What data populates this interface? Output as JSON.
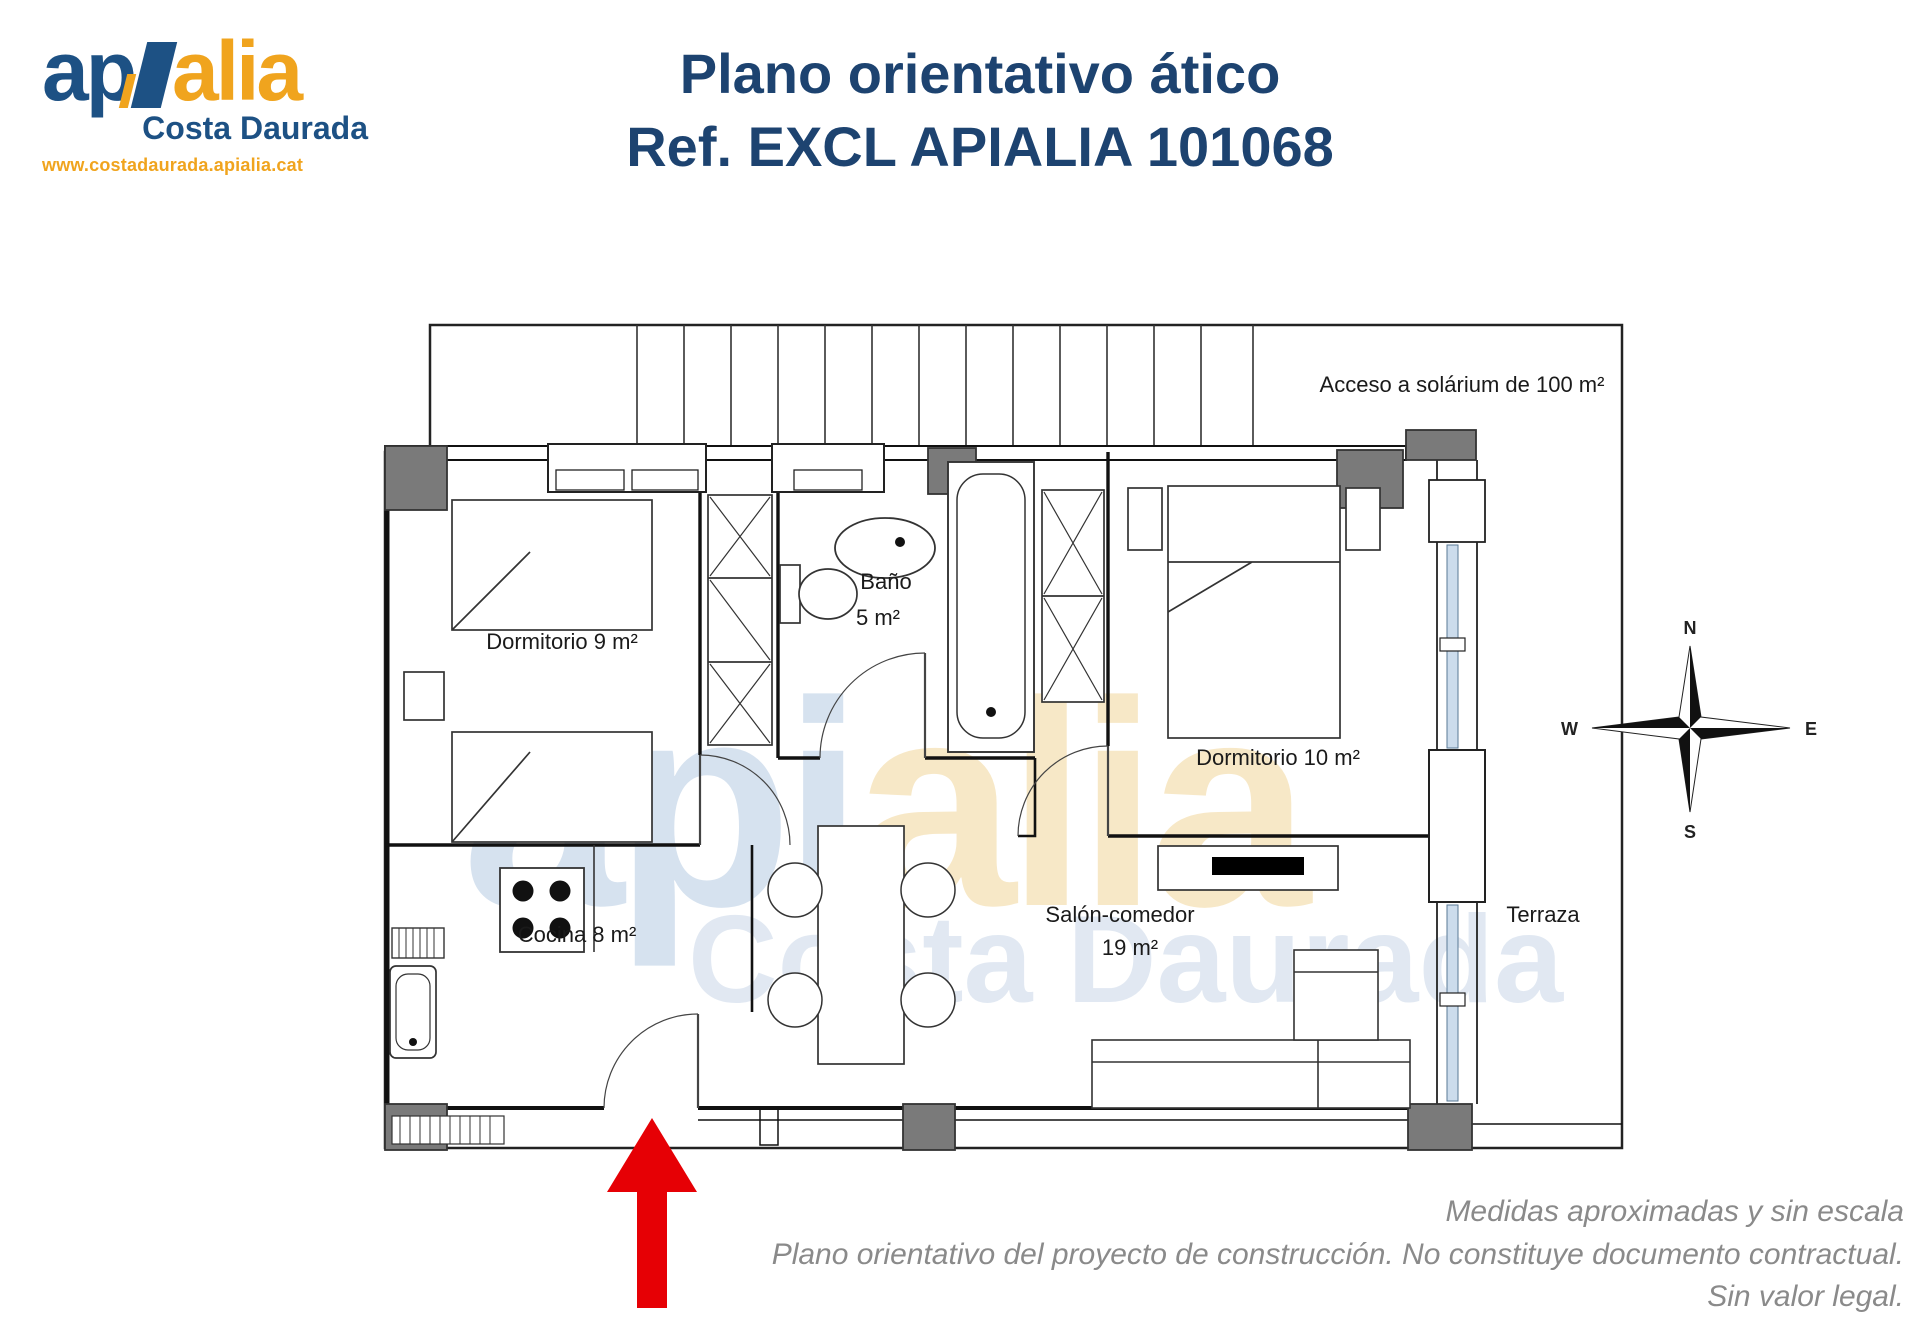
{
  "header": {
    "logo": {
      "word_start": "ap",
      "word_end": "alia",
      "tagline": "Costa Daurada",
      "website": "www.costadaurada.apialia.cat"
    },
    "title_line1": "Plano orientativo ático",
    "title_line2": "Ref. EXCL APIALIA 101068"
  },
  "plan": {
    "labels": {
      "solarium": "Acceso a solárium de 100 m²",
      "dormitorio9": "Dormitorio 9 m²",
      "bano_line1": "Baño",
      "bano_line2": "5 m²",
      "dormitorio10": "Dormitorio 10 m²",
      "cocina": "Cocina 8 m²",
      "salon_line1": "Salón-comedor",
      "salon_line2": "19 m²",
      "terraza": "Terraza"
    },
    "compass": {
      "north": "N",
      "south": "S",
      "east": "E",
      "west": "W"
    },
    "watermark": {
      "word_start": "api",
      "word_end": "alia",
      "tagline": "Costa Daurada"
    }
  },
  "footer": {
    "line1": "Medidas aproximadas y sin escala",
    "line2": "Plano orientativo del proyecto de construcción. No constituye documento contractual.",
    "line3": "Sin valor legal."
  },
  "colors": {
    "brand_blue": "#1d5184",
    "brand_orange": "#f0a41e",
    "title_blue": "#1d4370",
    "arrow_red": "#e60005",
    "pillar_gray": "#7a7a7a",
    "footer_gray": "#8a8a8a",
    "watermark_blue": "#b5cbe3",
    "watermark_yellow": "#f6e3ba",
    "window_blue": "#ccdcec"
  }
}
